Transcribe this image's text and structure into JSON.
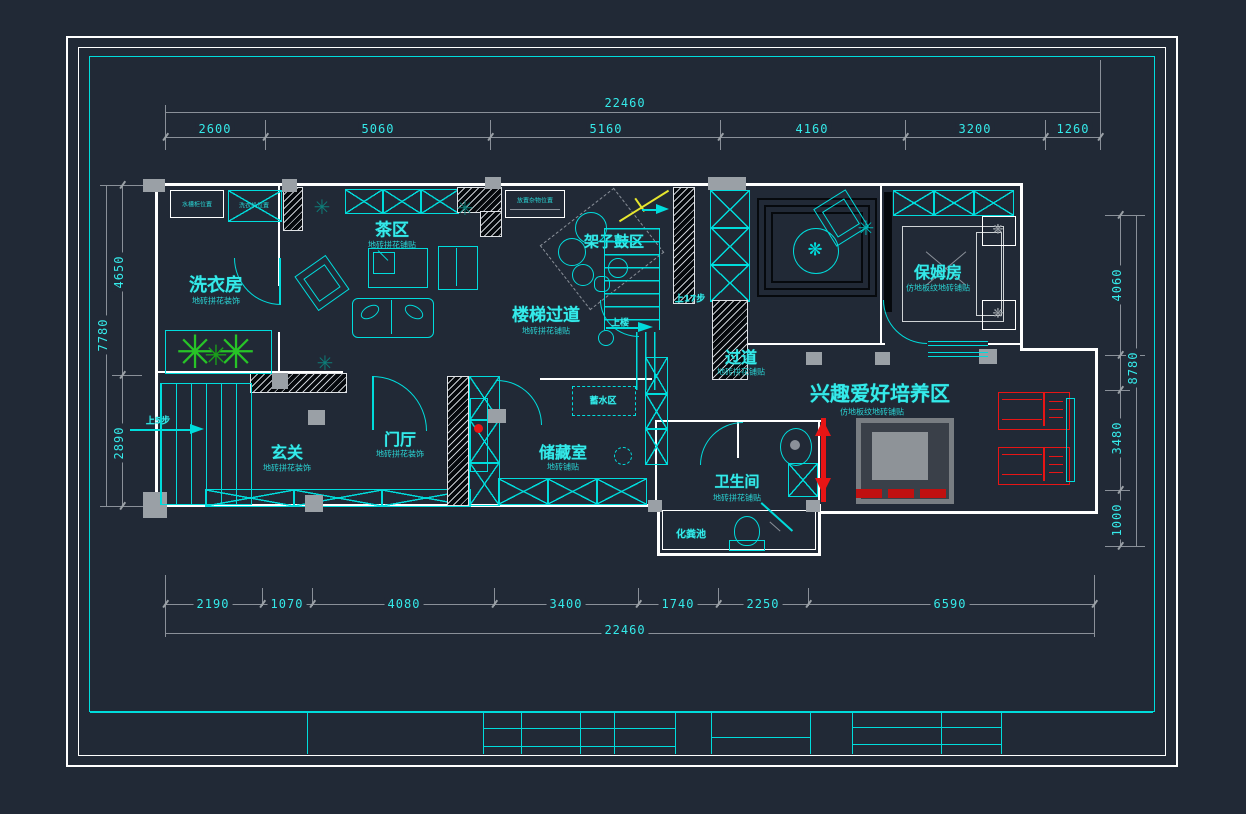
{
  "sheet": {
    "bg": "#212936",
    "frame_color": "#ffffff",
    "accent": "#00dcdc"
  },
  "colors": {
    "cyan": "#00dcdc",
    "text": "#35eaea",
    "wall": "#ffffff",
    "column": "#9aa0a6",
    "dim_line": "#8a9099",
    "plant": "#27c427",
    "red": "#e81515",
    "yellow": "#e6e62e"
  },
  "dimensions": {
    "top": {
      "total": "22460",
      "segments": [
        "2600",
        "5060",
        "5160",
        "4160",
        "3200",
        "1260"
      ]
    },
    "bottom": {
      "total": "22460",
      "segments": [
        "2190",
        "1070",
        "4080",
        "3400",
        "1740",
        "2250",
        "6590"
      ]
    },
    "left": {
      "total": "7780",
      "upper": "4650",
      "lower": "2890"
    },
    "right": {
      "total": "8780",
      "upper": "4060",
      "middle": "3480",
      "lower": "1000"
    }
  },
  "rooms": {
    "laundry": {
      "name": "洗衣房",
      "note": "地砖拼花装饰"
    },
    "tea": {
      "name": "茶区",
      "note": "地砖拼花铺贴"
    },
    "drums": {
      "name": "架子鼓区"
    },
    "stairhall": {
      "name": "楼梯过道",
      "note": "地砖拼花铺贴"
    },
    "corridor": {
      "name": "过道",
      "note": "地砖拼花铺贴"
    },
    "nanny": {
      "name": "保姆房",
      "note": "仿地板纹地砖铺贴"
    },
    "entry": {
      "name": "玄关",
      "note": "地砖拼花装饰"
    },
    "foyer": {
      "name": "门厅",
      "note": "地砖拼花装饰"
    },
    "storage": {
      "name": "储藏室",
      "note": "地砖铺贴"
    },
    "bath": {
      "name": "卫生间",
      "note": "地砖拼花铺贴"
    },
    "septic": {
      "name": "化粪池"
    },
    "hobby": {
      "name": "兴趣爱好培养区",
      "note": "仿地板纹地砖铺贴"
    }
  },
  "annotations": {
    "stair_main": "上17步",
    "stair_up": "上楼",
    "stair_entry": "上5步",
    "water_zone": "蓄水区",
    "note_sink": "水槽柜位置",
    "note_washer": "洗衣机位置",
    "note_shelf": "放置杂物位置"
  }
}
